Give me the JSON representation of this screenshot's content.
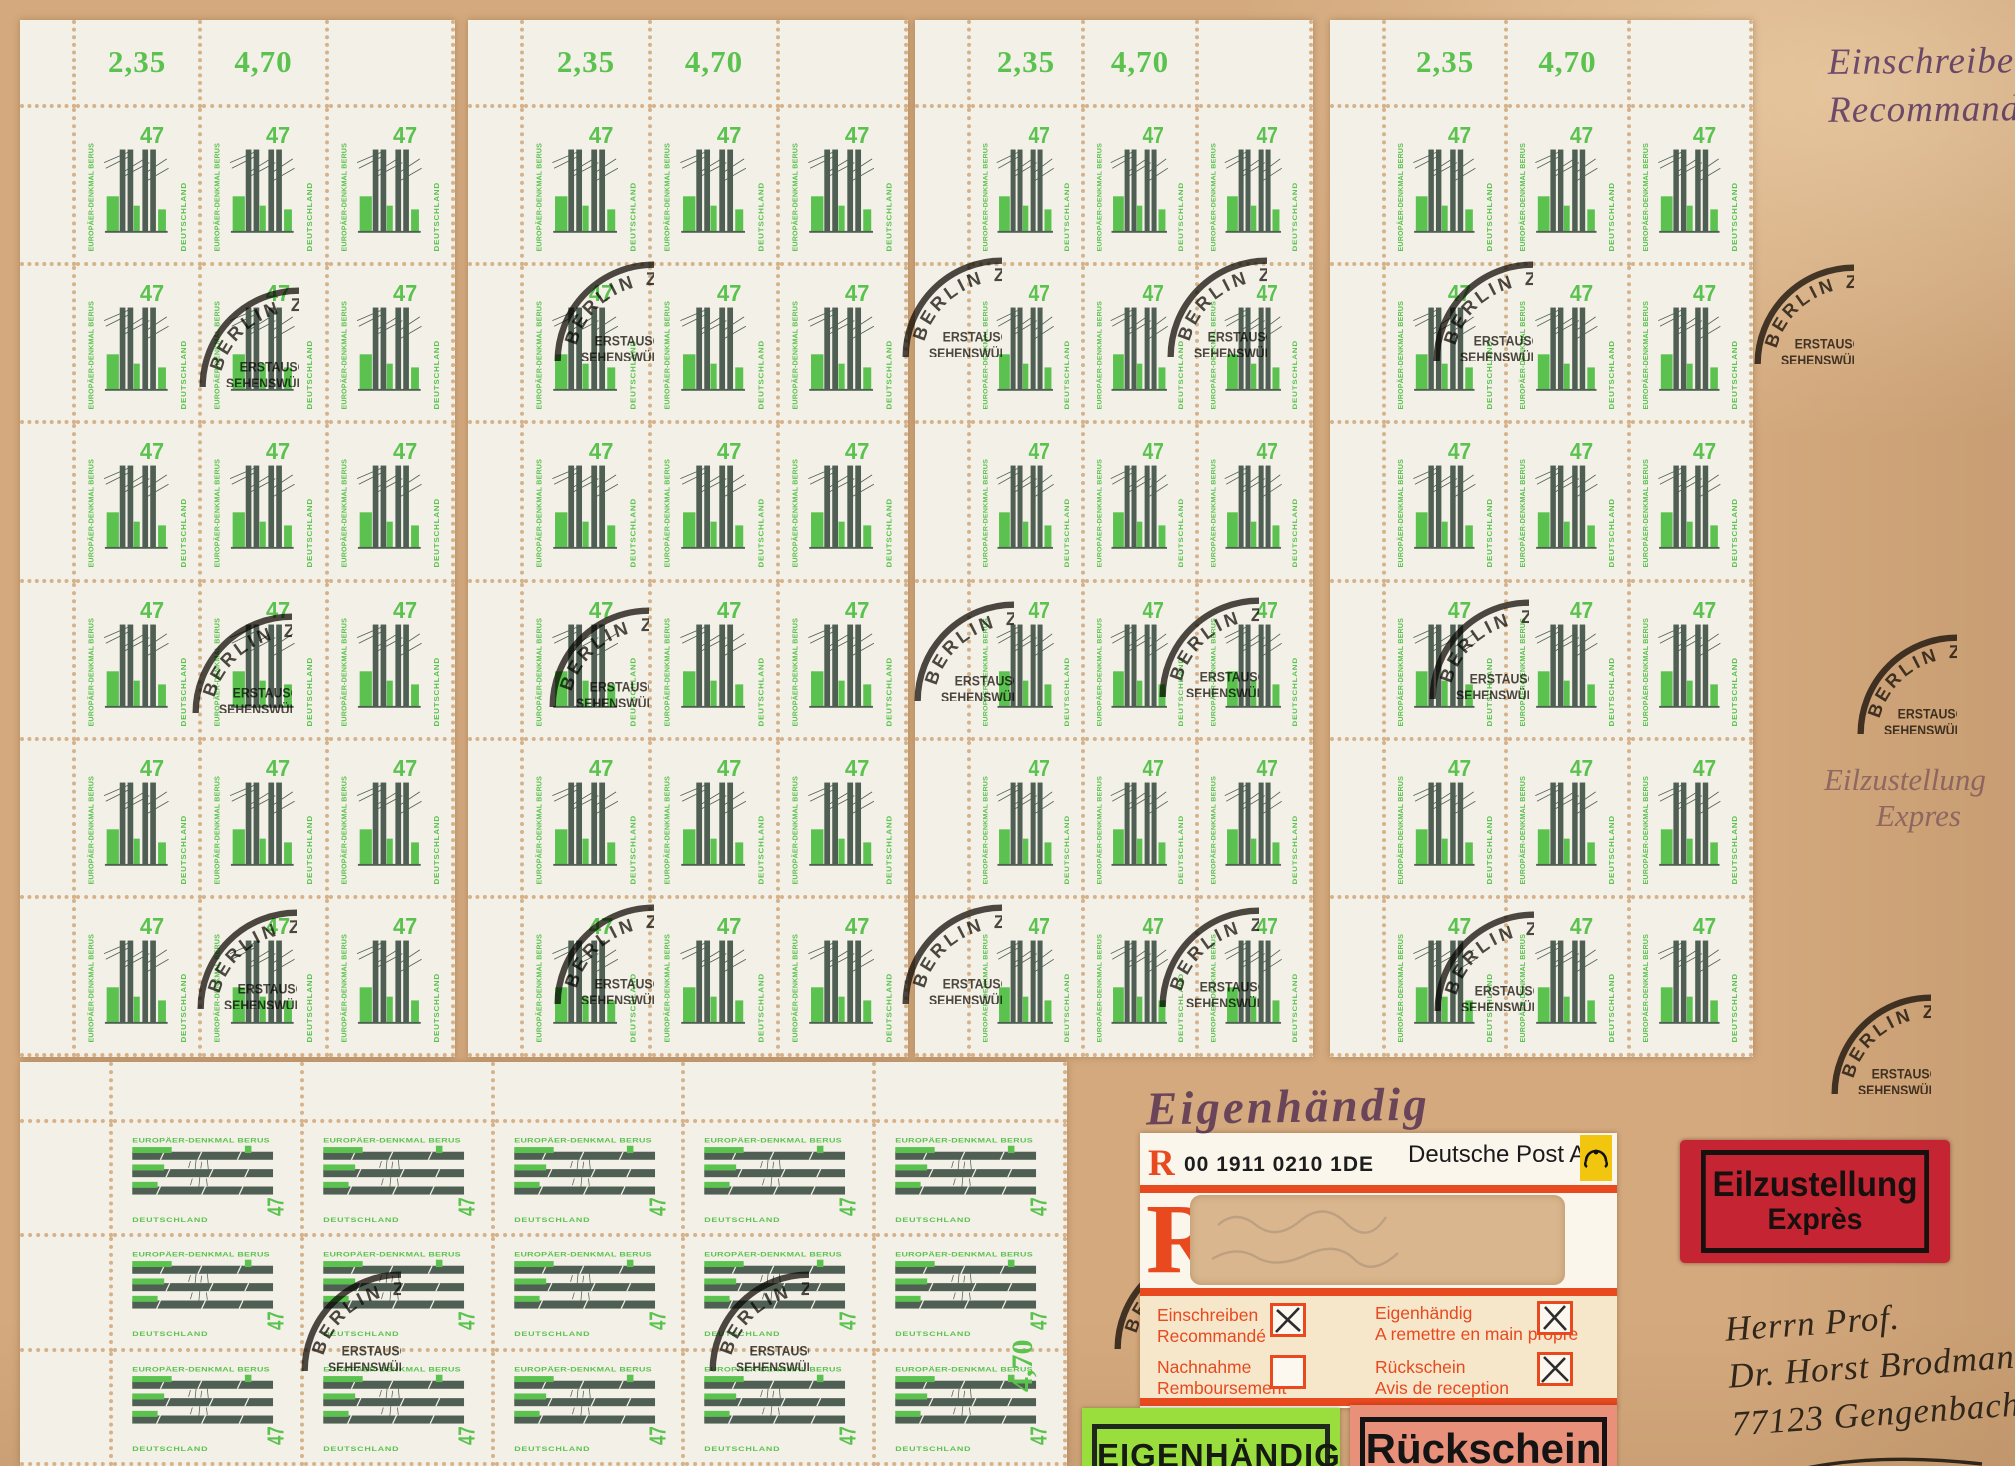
{
  "stamp": {
    "value": "47",
    "name": "EUROPÄER-DENKMAL BERUS",
    "country": "DEUTSCHLAND"
  },
  "sheet_margins": {
    "values": [
      "2,35",
      "4,70"
    ],
    "rotated_value": "4,70"
  },
  "postmark": {
    "city": "BERLIN ZENTRUM",
    "lines": [
      "ERSTAUSGABETAG",
      "SEHENSWÜRDIGKEITEN",
      "ROLLENMARKEN-",
      "DAUERSERIE"
    ],
    "date": "17.07.1997",
    "postal_code": "10878",
    "positions": [
      [
        190,
        278
      ],
      [
        545,
        252
      ],
      [
        893,
        248
      ],
      [
        1158,
        248
      ],
      [
        1424,
        252
      ],
      [
        1745,
        255
      ],
      [
        183,
        604
      ],
      [
        540,
        598
      ],
      [
        905,
        592
      ],
      [
        1150,
        588
      ],
      [
        1420,
        590
      ],
      [
        1848,
        625
      ],
      [
        188,
        900
      ],
      [
        545,
        895
      ],
      [
        893,
        895
      ],
      [
        1150,
        898
      ],
      [
        1425,
        902
      ],
      [
        1822,
        985
      ],
      [
        292,
        1262
      ],
      [
        700,
        1262
      ],
      [
        1105,
        1240
      ]
    ]
  },
  "hand_stamps": {
    "registered": {
      "line1": "Einschreiben",
      "line2": "Recommandé"
    },
    "express_purple": {
      "line1": "Eilzustellung",
      "line2": "Expres"
    },
    "eigenhandig": "Eigenhändig"
  },
  "dp_label": {
    "r_small": "R",
    "barcode_text": "00 1911 0210 1DE",
    "brand": "Deutsche Post AG",
    "r_large": "R",
    "options": [
      {
        "de": "Einschreiben",
        "fr": "Recommandé",
        "checked": true
      },
      {
        "de": "Eigenhändig",
        "fr": "A remettre en main propre",
        "checked": true
      },
      {
        "de": "Nachnahme",
        "fr": "Remboursement",
        "checked": false
      },
      {
        "de": "Rückschein",
        "fr": "Avis de reception",
        "checked": true
      }
    ]
  },
  "express_label": {
    "line1": "Eilzustellung",
    "line2": "Exprès"
  },
  "bottom_labels": {
    "eigenhandig": "EIGENHÄNDIG",
    "rueckschein": "Rückschein"
  },
  "address": {
    "line1": "Herrn Prof.",
    "line2": "Dr. Horst Brodmann",
    "line3": "77123 Gengenbach"
  },
  "layout": {
    "large_sheets": [
      {
        "x": 20,
        "y": 20,
        "w": 435,
        "h": 1037
      },
      {
        "x": 468,
        "y": 20,
        "w": 440,
        "h": 1037
      },
      {
        "x": 915,
        "y": 20,
        "w": 398,
        "h": 1037
      },
      {
        "x": 1330,
        "y": 20,
        "w": 423,
        "h": 1037
      }
    ],
    "large_grid": {
      "margin_w": 56,
      "margin_h": 88,
      "cols": 3,
      "rows": 6
    },
    "bottom_sheet": {
      "x": 20,
      "y": 1062,
      "w": 1047,
      "h": 404,
      "margin_w": 93,
      "margin_h": 61,
      "cols": 5,
      "rows": 3
    }
  },
  "colors": {
    "envelope": "#d4a97e",
    "sheet": "#f3f0e7",
    "perf": "#d5b28a",
    "stamp_green": "#5bc24f",
    "stamp_dark": "#4f5f53",
    "ink": "#26231d",
    "purple": "#6c50a8",
    "label_red": "#e8491f",
    "label_cream": "#f6e7cb",
    "express_red": "#c52532",
    "green_label": "#9ade3e",
    "rs_bg": "#e8907a",
    "post_yellow": "#f2c50e"
  }
}
